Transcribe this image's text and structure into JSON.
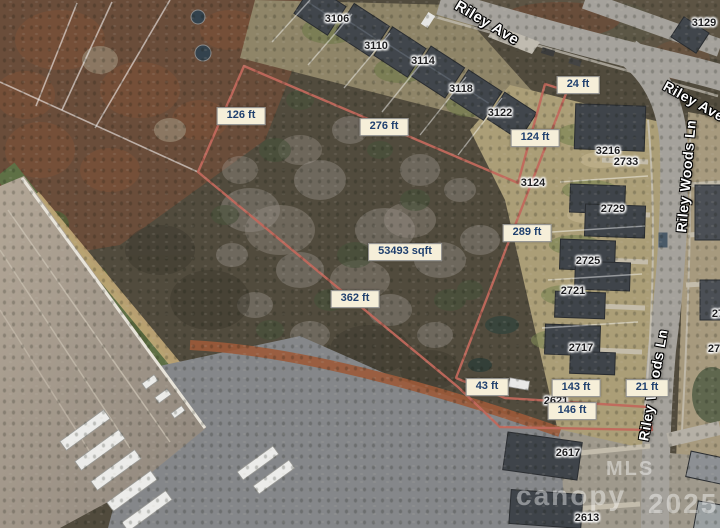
{
  "map_title": "aerial parcel survey view",
  "streets": {
    "riley_ave_top": "Riley Ave",
    "riley_ave_right": "Riley Ave",
    "riley_woods_upper": "Riley Woods Ln",
    "riley_woods_lower": "Riley Woods Ln"
  },
  "area_label": {
    "text": "53493 sqft"
  },
  "measurements": [
    {
      "text": "126 ft"
    },
    {
      "text": "276 ft"
    },
    {
      "text": "24 ft"
    },
    {
      "text": "124 ft"
    },
    {
      "text": "289 ft"
    },
    {
      "text": "362 ft"
    },
    {
      "text": "43 ft"
    },
    {
      "text": "143 ft"
    },
    {
      "text": "21 ft"
    },
    {
      "text": "146 ft"
    }
  ],
  "house_numbers": [
    {
      "text": "3106"
    },
    {
      "text": "3110"
    },
    {
      "text": "3114"
    },
    {
      "text": "3118"
    },
    {
      "text": "3122"
    },
    {
      "text": "3129"
    },
    {
      "text": "3216"
    },
    {
      "text": "2733"
    },
    {
      "text": "3124"
    },
    {
      "text": "2729"
    },
    {
      "text": "2725"
    },
    {
      "text": "2721"
    },
    {
      "text": "2717"
    },
    {
      "text": "2621"
    },
    {
      "text": "2617"
    },
    {
      "text": "2613"
    },
    {
      "text": "27"
    },
    {
      "text": "271"
    }
  ],
  "watermark": {
    "mls": "MLS",
    "brand": "canopy",
    "year": "2025"
  },
  "colors": {
    "parcel_line": "#c1685c",
    "label_bg": "#f6efd9",
    "label_text": "#20406e",
    "label_border": "#8b8b8b",
    "street_text": "#ffffff",
    "watermark_text": "rgba(255,255,255,0.42)"
  }
}
